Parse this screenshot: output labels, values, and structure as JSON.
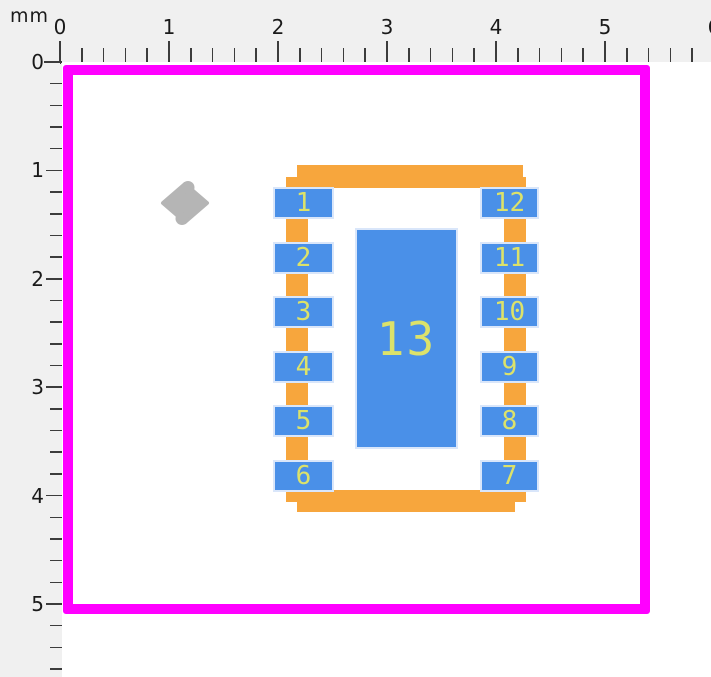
{
  "colors": {
    "canvas_bg": "#ffffff",
    "ruler_bg": "#f0f0f0",
    "tick": "#3c3c3c",
    "label": "#1a1a1a",
    "courtyard": "#ff00ff",
    "silkscreen": "#f7a63d",
    "pad_fill": "#4a90e8",
    "pad_border": "#d9e6fa",
    "pad_number": "#dce26a",
    "origin_marker": "#b5b5b5"
  },
  "rulers": {
    "unit_label": "mm",
    "minor_divisions_per_unit": 5,
    "top": {
      "origin_px": 60,
      "px_per_unit": 109,
      "length_px": 711,
      "labels": [
        "0",
        "1",
        "2",
        "3",
        "4",
        "5",
        "6"
      ]
    },
    "left": {
      "origin_px": 62,
      "px_per_unit": 108.4,
      "length_px": 677,
      "labels": [
        "0",
        "1",
        "2",
        "3",
        "4",
        "5"
      ]
    }
  },
  "footprint": {
    "courtyard": {
      "x": 63,
      "y": 65,
      "w": 587,
      "h": 549,
      "stroke_px": 10
    },
    "silkscreen_bars": [
      {
        "name": "silkscreen-top",
        "x": 297,
        "y": 165,
        "w": 226,
        "h": 23
      },
      {
        "name": "silkscreen-bottom",
        "x": 297,
        "y": 490,
        "w": 218,
        "h": 22
      },
      {
        "name": "silkscreen-left",
        "x": 286,
        "y": 177,
        "w": 22,
        "h": 325
      },
      {
        "name": "silkscreen-right",
        "x": 504,
        "y": 177,
        "w": 22,
        "h": 325
      }
    ],
    "pads": [
      {
        "number": "1",
        "x": 275,
        "y": 189,
        "w": 57,
        "h": 28
      },
      {
        "number": "2",
        "x": 275,
        "y": 244,
        "w": 57,
        "h": 28
      },
      {
        "number": "3",
        "x": 275,
        "y": 298,
        "w": 57,
        "h": 28
      },
      {
        "number": "4",
        "x": 275,
        "y": 353,
        "w": 57,
        "h": 28
      },
      {
        "number": "5",
        "x": 275,
        "y": 407,
        "w": 57,
        "h": 28
      },
      {
        "number": "6",
        "x": 275,
        "y": 462,
        "w": 57,
        "h": 28
      },
      {
        "number": "12",
        "x": 482,
        "y": 189,
        "w": 55,
        "h": 28
      },
      {
        "number": "11",
        "x": 482,
        "y": 244,
        "w": 55,
        "h": 28
      },
      {
        "number": "10",
        "x": 482,
        "y": 298,
        "w": 55,
        "h": 28
      },
      {
        "number": "9",
        "x": 482,
        "y": 353,
        "w": 55,
        "h": 28
      },
      {
        "number": "8",
        "x": 482,
        "y": 407,
        "w": 55,
        "h": 28
      },
      {
        "number": "7",
        "x": 482,
        "y": 462,
        "w": 55,
        "h": 28
      }
    ],
    "center_pad": {
      "number": "13",
      "x": 357,
      "y": 230,
      "w": 99,
      "h": 217
    },
    "origin_marker": {
      "cx": 185,
      "cy": 203
    }
  }
}
